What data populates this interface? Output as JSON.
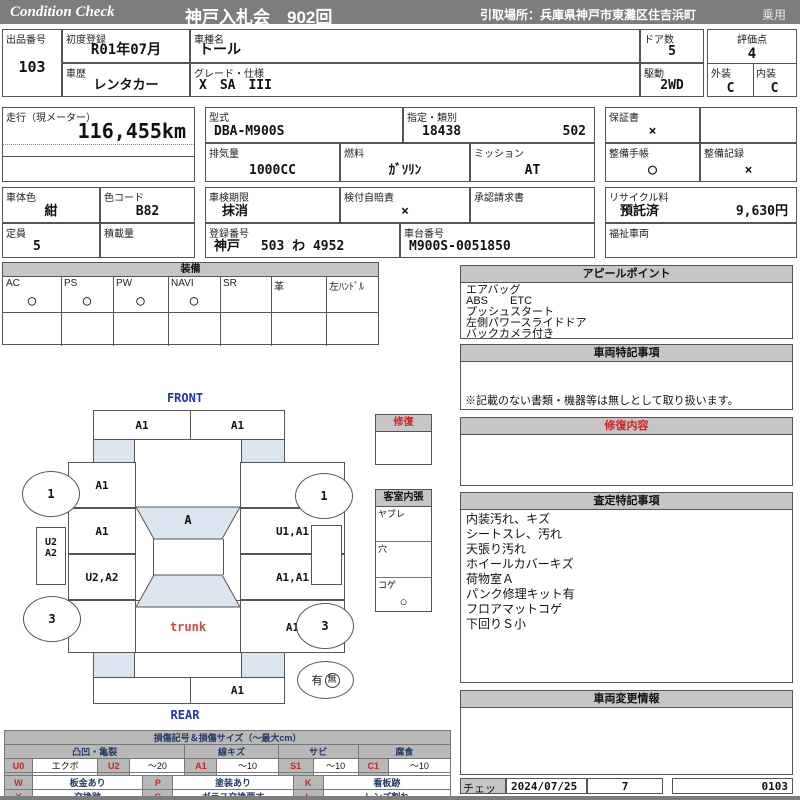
{
  "topbar": {
    "brand": "Condition  Check",
    "auction": "神戸入札会　902回",
    "pickup": "引取場所：兵庫県神戸市東灘区住吉浜町",
    "usage": "乗用"
  },
  "fields": {
    "lot": {
      "label": "出品番号",
      "value": "103"
    },
    "first_reg": {
      "label": "初度登録",
      "value": "R01年07月"
    },
    "model_name": {
      "label": "車種名",
      "value": "トール"
    },
    "doors": {
      "label": "ドア数",
      "value": "5"
    },
    "score": {
      "label": "評価点",
      "value": "4"
    },
    "history": {
      "label": "車歴",
      "value": "レンタカー"
    },
    "grade": {
      "label": "グレード・仕様",
      "value": "X　SA　III"
    },
    "drive": {
      "label": "駆動",
      "value": "2WD"
    },
    "exterior": {
      "label": "外装",
      "value": "C"
    },
    "interior": {
      "label": "内装",
      "value": "C"
    },
    "mileage": {
      "label": "走行（現メーター）",
      "value": "116,455km"
    },
    "model_code": {
      "label": "型式",
      "value": "DBA-M900S"
    },
    "designation": {
      "label": "指定・類別",
      "value1": "18438",
      "value2": "502"
    },
    "warranty": {
      "label": "保証書",
      "value": "×"
    },
    "displacement": {
      "label": "排気量",
      "value": "1000CC"
    },
    "fuel": {
      "label": "燃料",
      "value": "ｶﾞｿﾘﾝ"
    },
    "transmission": {
      "label": "ミッション",
      "value": "AT"
    },
    "maint_book": {
      "label": "整備手帳",
      "value": "○"
    },
    "maint_record": {
      "label": "整備記録",
      "value": "×"
    },
    "body_color": {
      "label": "車体色",
      "value": "紺"
    },
    "color_code": {
      "label": "色コード",
      "value": "B82"
    },
    "inspection": {
      "label": "車検期限",
      "value": "抹消"
    },
    "jibaiseki": {
      "label": "検付自賠責",
      "value": "×"
    },
    "approval": {
      "label": "承認請求書",
      "value": ""
    },
    "recycle": {
      "label": "リサイクル料",
      "status": "預託済",
      "amount": "9,630円"
    },
    "capacity": {
      "label": "定員",
      "value": "5"
    },
    "payload": {
      "label": "積載量",
      "value": ""
    },
    "reg_no": {
      "label": "登録番号",
      "value": "神戸　 503 わ  4952"
    },
    "chassis_no": {
      "label": "車台番号",
      "value": "M900S-0051850"
    },
    "welfare": {
      "label": "福祉車両",
      "value": ""
    }
  },
  "equipment": {
    "title": "装備",
    "columns": [
      {
        "label": "AC",
        "value": "○"
      },
      {
        "label": "PS",
        "value": "○"
      },
      {
        "label": "PW",
        "value": "○"
      },
      {
        "label": "NAVI",
        "value": "○"
      },
      {
        "label": "SR",
        "value": ""
      },
      {
        "label": "革",
        "value": ""
      },
      {
        "label": "左ﾊﾝﾄﾞﾙ",
        "value": ""
      }
    ]
  },
  "appeal": {
    "title": "アピールポイント",
    "lines": [
      "エアバッグ",
      "ABS　　ETC",
      "プッシュスタート",
      "左側パワースライドドア",
      "バックカメラ付き"
    ]
  },
  "special_notes": {
    "title": "車両特記事項",
    "note": "※記載のない書類・機器等は無しとして取り扱います。"
  },
  "repair_detail": {
    "title": "修復内容"
  },
  "assessment": {
    "title": "査定特記事項",
    "lines": [
      "内装汚れ、キズ",
      "シートスレ、汚れ",
      "天張り汚れ",
      "ホイールカバーキズ",
      "荷物室Ａ",
      "パンク修理キット有",
      "フロアマットコゲ",
      "下回りＳ小"
    ]
  },
  "change_info": {
    "title": "車両変更情報"
  },
  "check": {
    "label": "チェック",
    "date": "2024/07/25",
    "count": "7",
    "code": "0103"
  },
  "diagram": {
    "front_label": "FRONT",
    "rear_label": "REAR",
    "front_bumper": [
      "A1",
      "A1"
    ],
    "left_fender": "A1",
    "left_front_door": "A1",
    "left_rear_door": "U2,A2",
    "right_fender": "",
    "right_front_door": "U1,A1",
    "right_rear_door": "A1,A1",
    "windshield": "A",
    "trunk_label": "trunk",
    "right_rear_quarter": "A1",
    "rear_bumper": [
      "",
      "A1"
    ],
    "left_sill": [
      "U2",
      "A2"
    ],
    "wheels": {
      "front_left": "1",
      "front_right": "1",
      "rear_left": "3",
      "rear_right": "3"
    },
    "spare": {
      "has": "有",
      "none": "無"
    },
    "repair_flag": {
      "title": "修復"
    },
    "cabin_lining": {
      "title": "客室内張",
      "rows": [
        {
          "label": "ヤブレ",
          "value": ""
        },
        {
          "label": "穴",
          "value": ""
        },
        {
          "label": "コゲ",
          "value": "○"
        }
      ]
    }
  },
  "legend": {
    "title": "損傷記号＆損傷サイズ（〜最大cm）",
    "groups": [
      "凸凹・亀裂",
      "線キズ",
      "サビ",
      "腐食"
    ],
    "size_rows": [
      [
        "U0",
        "エクボ",
        "U2",
        "〜20",
        "A1",
        "〜10",
        "S1",
        "〜10",
        "C1",
        "〜10"
      ],
      [
        "U1",
        "〜10",
        "U3",
        "20超",
        "A2",
        "10超",
        "S2",
        "10超",
        "C2",
        "10超"
      ]
    ],
    "code_rows": [
      [
        "W",
        "板金あり",
        "P",
        "塗装あり",
        "K",
        "看板跡"
      ],
      [
        "X",
        "交換跡",
        "G",
        "ガラス交換要す",
        "L",
        "レンズ割れ"
      ]
    ]
  }
}
